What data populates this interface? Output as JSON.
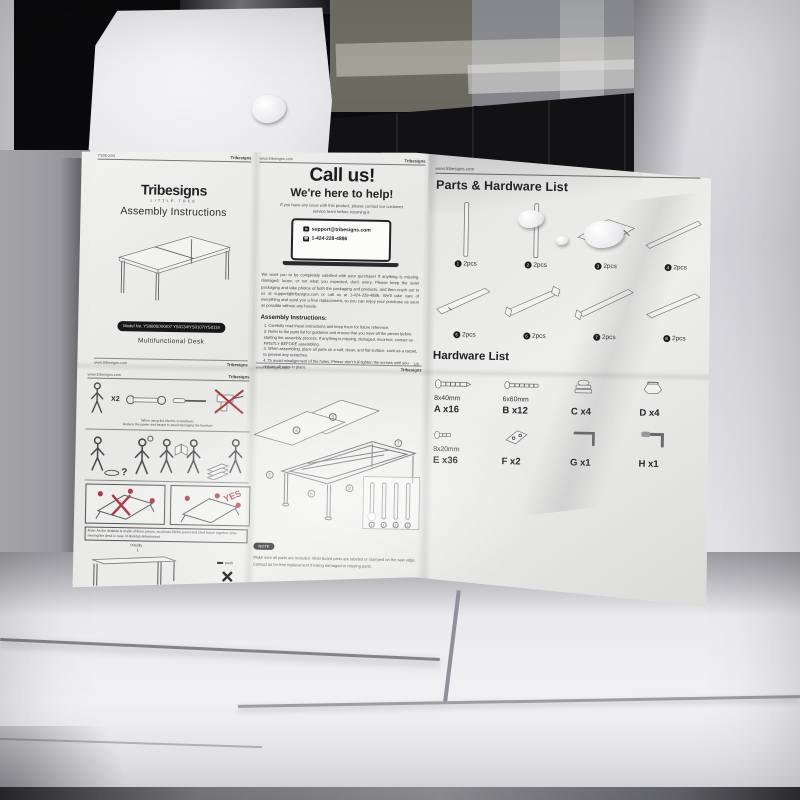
{
  "colors": {
    "accent_red": "#a93a44",
    "paper": "#ebebe9",
    "ink": "#333335",
    "pill_black": "#17171a"
  },
  "icons": {
    "email": "✉",
    "phone": "☎",
    "arrow_down": "↓"
  },
  "sheet": {
    "shared": {
      "site": "www.tribesigns.com",
      "brand": "Tribesigns"
    },
    "cover": {
      "header_code": "YS05-X04",
      "brand_sub": "LITTLE TREE",
      "title": "Assembly Instructions",
      "model": "Model No. YS0805/XK007 YS0134/YS0107/YS0119",
      "product": "Multifunctional Desk"
    },
    "callus": {
      "title": "Call us!",
      "subtitle": "We're here to help!",
      "contact_note": "If you have any issue with this product, please contact our customer service team before returning it.",
      "email": "support@tribesigns.com",
      "phone": "1-424-228-4886",
      "paragraph": "We want you to be completely satisfied with your purchase! If anything is missing, damaged, loose, or not what you expected, don't worry. Please keep the outer packaging and take photos of both the packaging and products, and then reach out to us at support@tribesigns.com or call us at 1-424-228-4886. We'll take care of everything and send you a free replacement, so you can enjoy your purchase as soon as possible without any hassle.",
      "assembly_heading": "Assembly Instructions:",
      "steps": [
        "1. Carefully read these instructions and keep them for future reference.",
        "2. Refer to the parts list for guidance and ensure that you have all the pieces before starting the assembly process. If anything is missing, damaged, incorrect, contact us FIRSTLY BEFORE assembling.",
        "3. When assembling, place all parts on a soft, clean, and flat surface, such as a carpet, to prevent any scratches.",
        "4. To avoid misalignment of the holes, Please don't full tighten the screws until you ensure all parts in place."
      ],
      "follow_label": "Follow Tribesigns:",
      "qr_labels": [
        "Facebook",
        "Instagram",
        "Pinterest",
        "YouTube",
        "TikTok"
      ],
      "page": "1/8"
    },
    "parts": {
      "title": "Parts & Hardware List",
      "items": [
        {
          "num": "1",
          "qty": "2pcs"
        },
        {
          "num": "2",
          "qty": "2pcs"
        },
        {
          "num": "3",
          "qty": "2pcs"
        },
        {
          "num": "4",
          "qty": "2pcs"
        },
        {
          "num": "5",
          "qty": "2pcs"
        },
        {
          "num": "6",
          "qty": "2pcs"
        },
        {
          "num": "7",
          "qty": "2pcs"
        },
        {
          "num": "8",
          "qty": "2pcs"
        }
      ]
    },
    "hardware": {
      "title": "Hardware List",
      "items": [
        {
          "size": "8x40mm",
          "label": "A x16"
        },
        {
          "size": "6x60mm",
          "label": "B x12"
        },
        {
          "size": "",
          "label": "C x4"
        },
        {
          "size": "",
          "label": "D x4"
        },
        {
          "size": "8x20mm",
          "label": "E x36"
        },
        {
          "size": "",
          "label": "F x2"
        },
        {
          "size": "",
          "label": "G x1"
        },
        {
          "size": "",
          "label": "H x1"
        }
      ]
    },
    "safety": {
      "x2": "X2",
      "tools_note_1": "When using the electric screwdriver,",
      "tools_note_2": "Reduce the power and torque to avoid damaging the furniture",
      "qmark": "?",
      "yes": "YES",
      "note1": "Note: As the desktop is made of three pieces, so please lift the panel and steel frame together when moving the desk in case of desktop deformation!",
      "directly": "Directly",
      "push": "push",
      "note2": "When moving, please do not push the desk directly on the ground, which do not damage the floor, but also will lift the table legs !!!",
      "page": "7/8"
    },
    "diagram": {
      "callouts": [
        "3",
        "3",
        "5",
        "6",
        "7",
        "8",
        "1",
        "1",
        "2",
        "2"
      ],
      "note_tag": "NOTE",
      "note_line1": "Make sure all parts are included. Most board parts are labeled or stamped on the saw edge.",
      "note_line2": "Contact us for free replacement if losing damaged or missing parts.",
      "page": "7/8"
    }
  }
}
